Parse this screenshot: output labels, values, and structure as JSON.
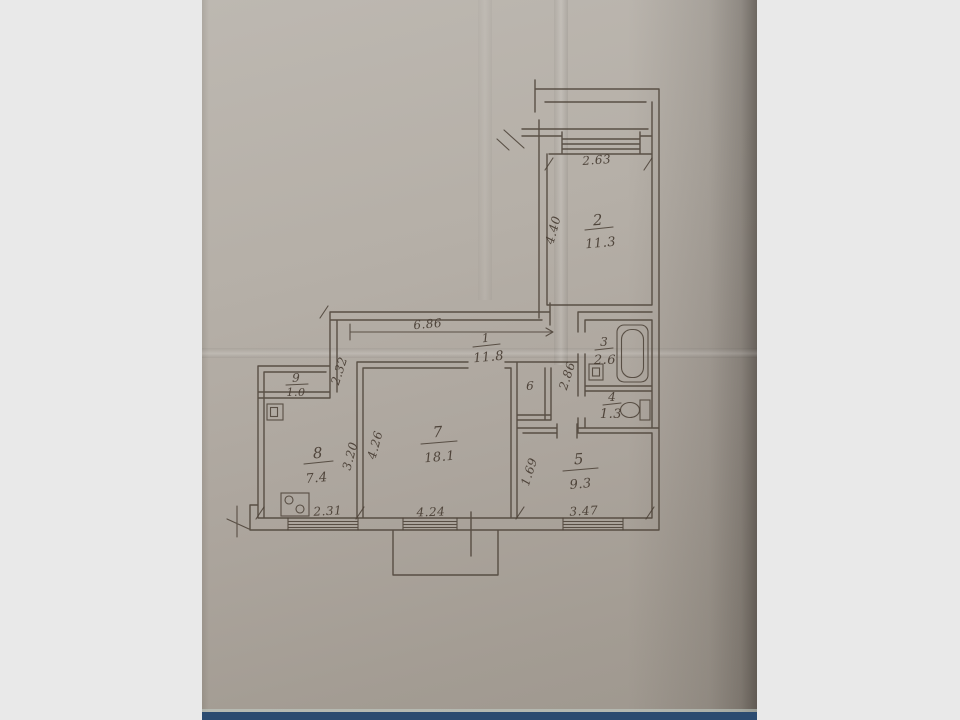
{
  "scene": {
    "background_color": "#e9e9e9",
    "paper_color": "#b2aca4",
    "ink_color": "#4c4238",
    "bottom_bar_color": "#2b4b70"
  },
  "floor_plan": {
    "rooms": {
      "hall": {
        "number": "1",
        "area": "11.8"
      },
      "room2": {
        "number": "2",
        "area": "11.3"
      },
      "bath": {
        "number": "3",
        "area": "2.6"
      },
      "wc": {
        "number": "4",
        "area": "1.3"
      },
      "room5": {
        "number": "5",
        "area": "9.3"
      },
      "closet": {
        "number": "6"
      },
      "living": {
        "number": "7",
        "area": "18.1"
      },
      "kitchen": {
        "number": "8",
        "area": "7.4"
      },
      "pantry": {
        "number": "9",
        "area": "1.0"
      }
    },
    "dimensions": {
      "room2_width": "2.63",
      "room2_depth": "4.40",
      "hall_length": "6.86",
      "hall_width": "2.32",
      "nook_depth": "2.86",
      "kitchen_depth": "3.20",
      "living_depth": "4.26",
      "room5_offset": "1.69",
      "kitchen_width": "2.31",
      "living_width": "4.24",
      "room5_width": "3.47"
    }
  }
}
